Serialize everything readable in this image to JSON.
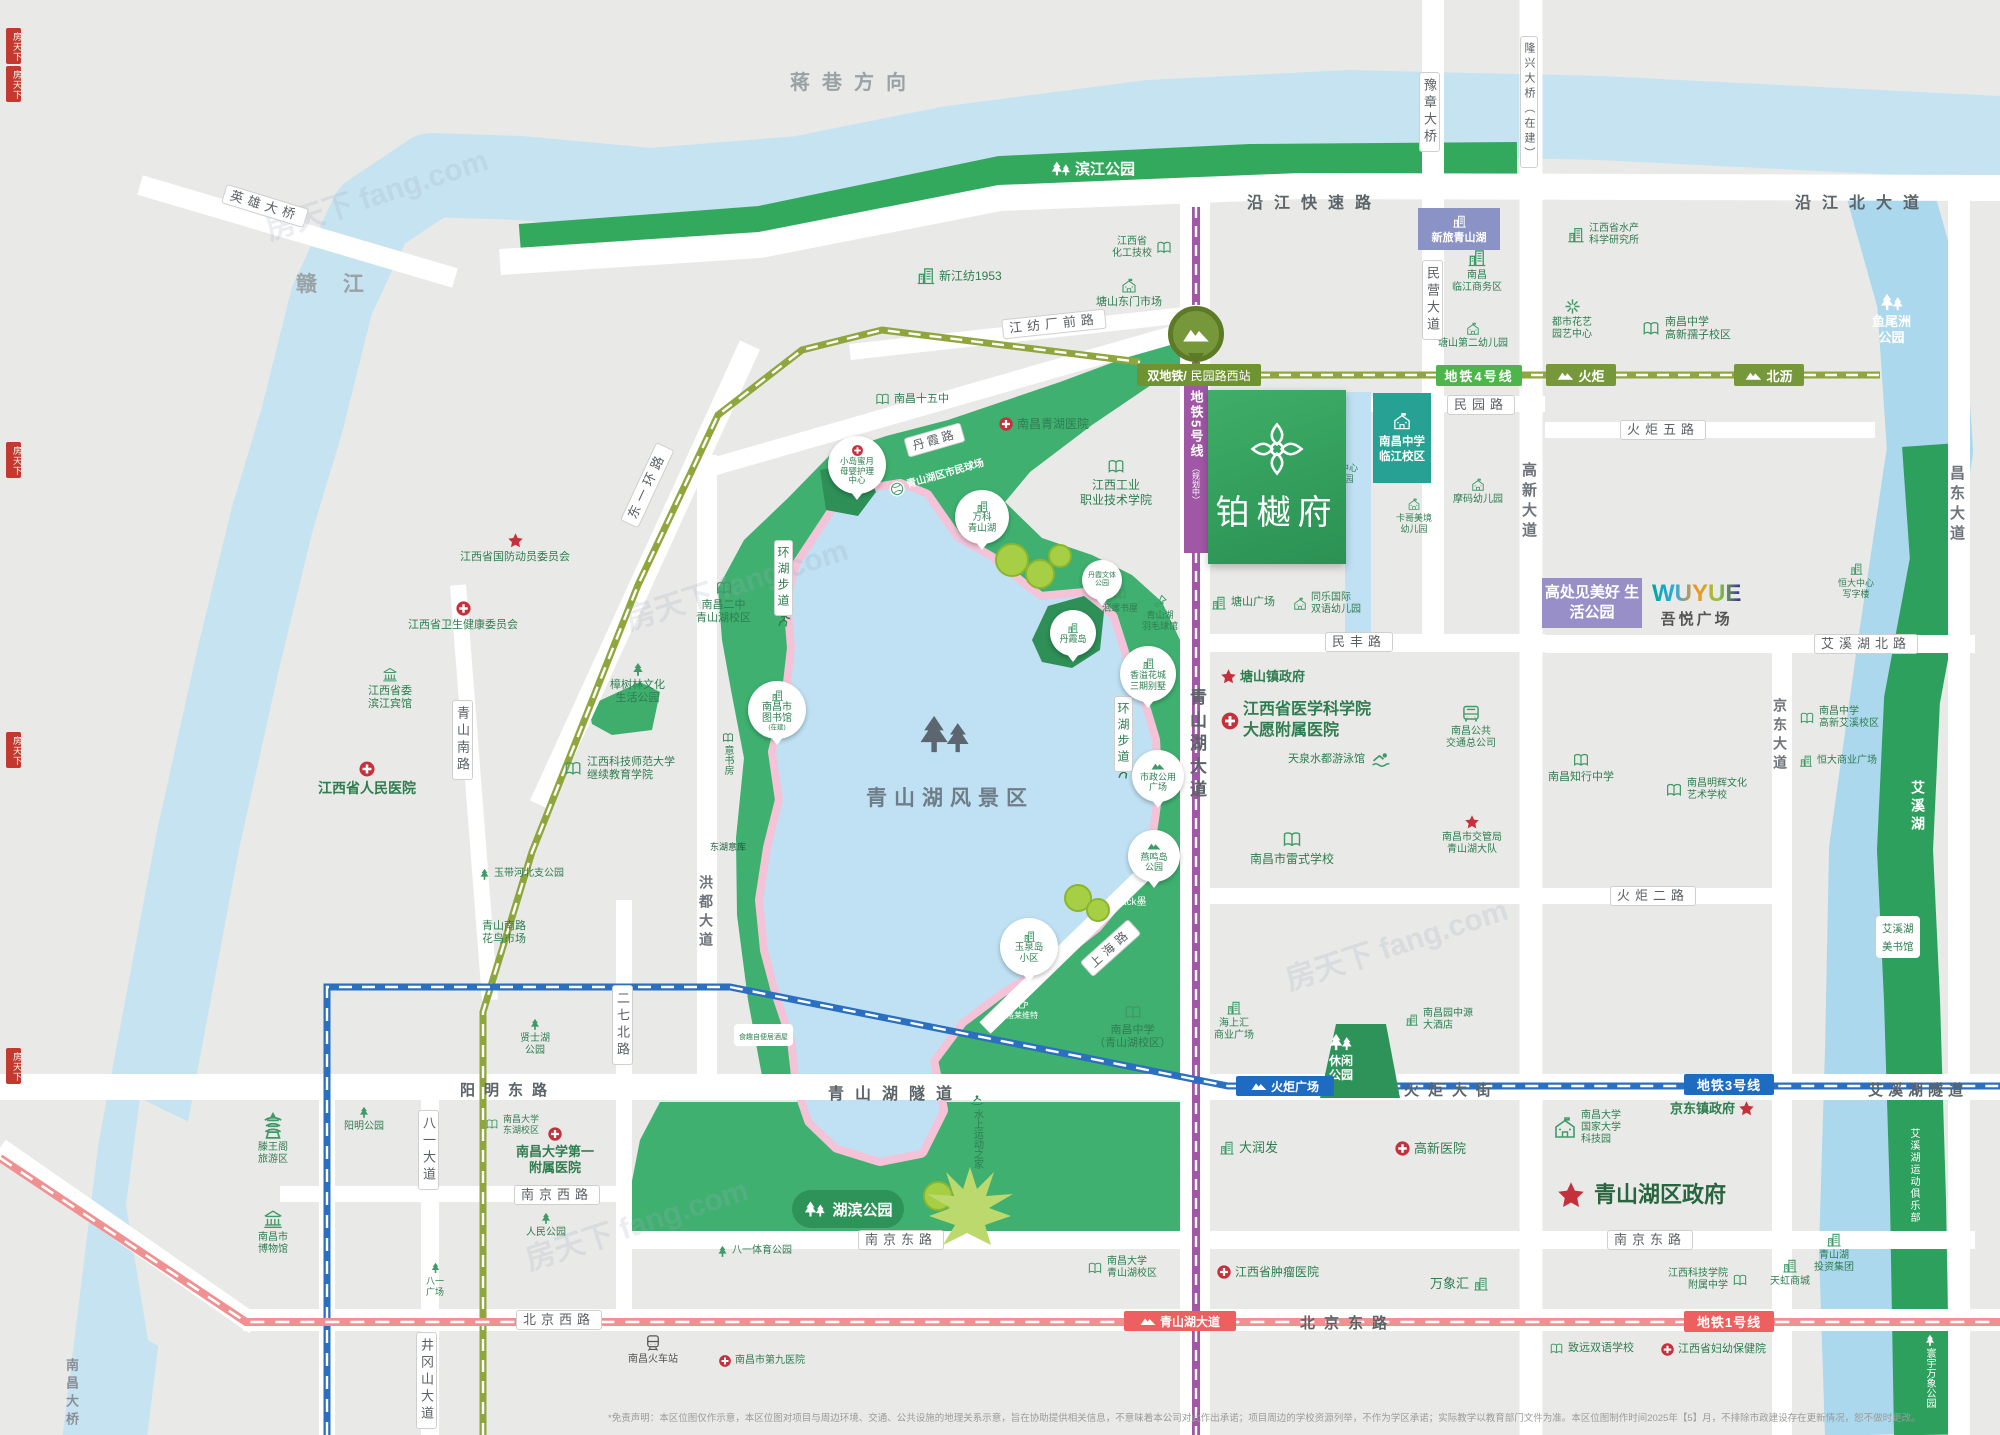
{
  "big": {
    "ganjiang": "赣 江",
    "jiangxiang": "蒋巷方向",
    "scenic": "青山湖风景区"
  },
  "metro": {
    "line1": "地铁1号线",
    "line3": "地铁3号线",
    "line4": "地铁4号线",
    "line5": "地铁5号线",
    "line5_status": "（规划中）",
    "st_prefix": "双地铁/",
    "st_minyuanxi": "民园路西站",
    "st_huoju": "火炬",
    "st_beili": "北沥",
    "st_huoju_sq": "火炬广场",
    "st_qsh_ave": "青山湖大道"
  },
  "roads": {
    "yanjiang_express": "沿江快速路",
    "yanjiang_north": "沿江北大道",
    "yuzhang_bridge": "豫章大桥",
    "longxing_bridge": "隆兴大桥（在建）",
    "yingxiong_bridge": "英雄大桥",
    "nanchang_bridge": "南昌大桥",
    "jiangfang_front": "江纺厂前路",
    "minying_ave": "民营大道",
    "minyuan": "民园路",
    "minfeng": "民丰路",
    "gaoxin_ave": "高新大道",
    "huoju5": "火炬五路",
    "huoju2": "火炬二路",
    "changdong_ave": "昌东大道",
    "aixihu_north": "艾溪湖北路",
    "jingdong_ave": "京东大道",
    "danxia": "丹霞路",
    "dongyihuan": "东一环路",
    "qingshan_south": "青山南路",
    "hongdu_ave": "洪都大道",
    "erqi_north": "二七北路",
    "shanghai": "上海路",
    "qsh_ave": "青山湖大道",
    "yangming_east": "阳明东路",
    "qsh_tunnel": "青山湖隧道",
    "huoju_ave": "火炬大街",
    "aixihu_tunnel": "艾溪湖隧道",
    "nanjing_east": "南京东路",
    "nanjing_west": "南京西路",
    "beijing_west": "北京西路",
    "beijing_east": "北京东路",
    "bayi_ave": "八一大道",
    "jinggangshan": "井冈山大道",
    "huanhu_trail": "环湖步道"
  },
  "parks": {
    "binjiang": "滨江公园",
    "yuweizhou": "鱼尾洲\n公园",
    "hubin": "湖滨公园",
    "xiuxian": "休闲\n公园",
    "bayi_sports": "八一体育公园",
    "renmin": "人民公园",
    "yangming": "阳明公园",
    "xianshihu": "贤士湖\n公园",
    "yudaihe": "玉带河北支公园",
    "zhangshulin": "樟树林文化\n生活公园",
    "aixihu": "艾溪湖",
    "aixihu_club": "艾溪湖运动俱乐部",
    "aixihu_lib": "艾溪湖\n美书馆",
    "huanyu": "寰宇万象公园",
    "danxia_island": "丹霞岛",
    "danxia_sports": "丹霞文体\n公园",
    "yanming_island": "燕鸣岛\n公园",
    "shizheng_plaza": "市政公用\n广场"
  },
  "pois": {
    "xinjiangfang": "新江纺1953",
    "tangshan_market": "塘山东门市场",
    "jx_chem": "江西省\n化工技校",
    "nc15": "南昌十五中",
    "qinghu_hosp": "南昌青湖医院",
    "jx_poly": "江西工业\n职业技术学院",
    "xinlv": "新旅青山湖",
    "linjiang_biz": "南昌\n临江商务区",
    "tangshan2_kg": "塘山第二幼儿园",
    "nczx_linjiang": "南昌中学\n临江校区",
    "moma_kg": "摩码幼儿园",
    "tangshan_center_kg": "塘山中心\n幼儿园",
    "kage_kg": "卡哥美境\n幼儿园",
    "tongle_kg": "同乐国际\n双语幼儿园",
    "tangshan_plaza": "塘山广场",
    "jx_aquatic": "江西省水产\n科学研究所",
    "dushi_garden": "都市花艺\n园艺中心",
    "nczx_ruzi": "南昌中学\n高新孺子校区",
    "jx_defense": "江西省国防动员委员会",
    "jx_health": "江西省卫生健康委员会",
    "jx_hotel": "江西省委\n滨江宾馆",
    "jx_people_hosp": "江西省人民医院",
    "nc2": "南昌二中\n青山湖校区",
    "jxstnu": "江西科技师范大学\n继续教育学院",
    "nclib": "南昌市\n图书馆",
    "nclib_status": "(在建)",
    "yishufang": "意书房",
    "donghu_yiku": "东湖意库",
    "xiaodao": "小岛蜜月\n母婴护理\n中心",
    "citizen_court": "青山湖区市民球场",
    "vanke": "万科\n青山湖",
    "huiluo": "洄螺书屋",
    "badminton": "青山湖\n羽毛球馆",
    "xiangyi": "香溢花城\n三期别墅",
    "black": "Black墨",
    "yuquan": "玉泉岛\n小区",
    "gelai": "格莱维特",
    "nczx_qsh": "南昌中学\n（青山湖校区）",
    "water_sports": "水上运动之家",
    "shiqu": "食趣自便居酒屋",
    "tangshan_gov": "塘山镇政府",
    "jx_medical": "江西省医学科学院\n大愿附属医院",
    "tianquan": "天泉水都游泳馆",
    "nc_bus": "南昌公共\n交通总公司",
    "nc_traffic": "南昌市交管局\n青山湖大队",
    "leishi": "南昌市雷式学校",
    "zhixing": "南昌知行中学",
    "minghui": "南昌明辉文化\n艺术学校",
    "hengda_center": "恒大中心\n写字楼",
    "hengda_plaza": "恒大商业广场",
    "nczx_aixi": "南昌中学\n高新艾溪校区",
    "haishanghui": "海上汇\n商业广场",
    "yuanzhongyuan": "南昌园中源\n大酒店",
    "ncu_park": "南昌大学\n国家大学\n科技园",
    "jingdong_gov": "京东镇政府",
    "qsh_gov": "青山湖区政府",
    "jxkj_high": "江西科技学院\n附属中学",
    "tianhong": "天虹商城",
    "qsh_invest": "青山湖\n投资集团",
    "zhiyuan": "致远双语学校",
    "jx_maternity": "江西省妇幼保健院",
    "darunfa": "大润发",
    "gaoxin_hosp": "高新医院",
    "ncu_qsh": "南昌大学\n青山湖校区",
    "jx_cancer": "江西省肿瘤医院",
    "wanxianghui": "万象汇",
    "ncu_donghu": "南昌大学\n东湖校区",
    "ncu_first_hosp": "南昌大学第一\n附属医院",
    "tengwang": "滕王阁\n旅游区",
    "nc_museum": "南昌市\n博物馆",
    "bayi_square": "八一\n广场",
    "nc_rail": "南昌火车站",
    "nc9_hosp": "南昌市第九医院",
    "flower_market": "青山南路\n花鸟市场"
  },
  "project": {
    "name": "铂樾府"
  },
  "banner": {
    "slogan": "高处见美好\n生活公园",
    "wuyue_en": "WUYUE",
    "wuyue_cn": "吾悦广场"
  },
  "watermark": {
    "text": "房天下 fang.com",
    "seal": "房天下"
  },
  "disclaimer": "*免责声明：本区位图仅作示意，本区位图对项目与周边环境、交通、公共设施的地理关系示意，旨在协助提供相关信息，不意味着本公司对此作出承诺；项目周边的学校资源列举，不作为学区承诺；实际教学以教育部门文件为准。本区位图制作时间2025年【5】月，不排除市政建设存在更新情况，恕不做时更改。"
}
